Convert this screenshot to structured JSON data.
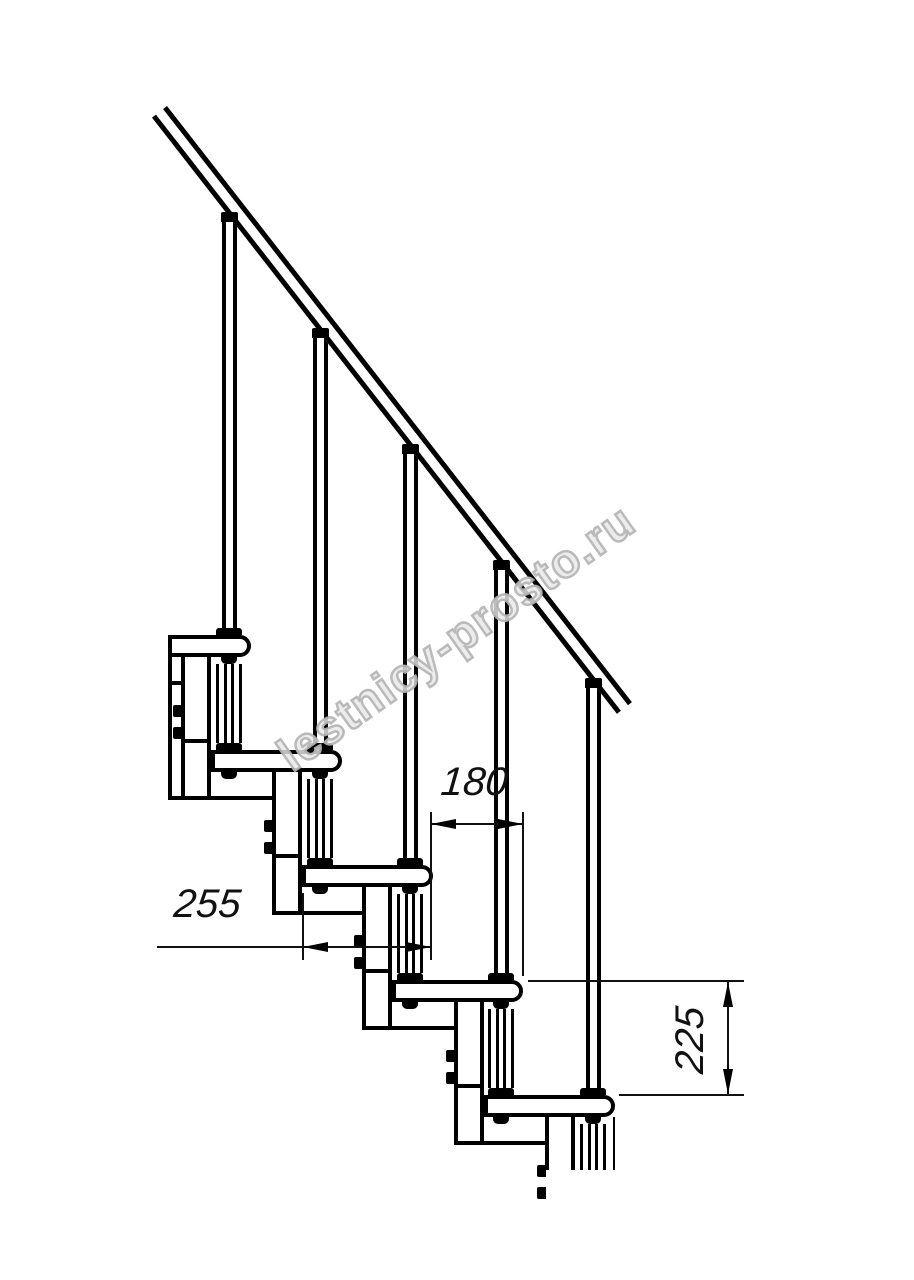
{
  "watermark": {
    "text": "lestnicy-prosto.ru",
    "color": "#bdbdbd"
  },
  "dimensions": {
    "run": {
      "value": "180"
    },
    "depth": {
      "value": "255"
    },
    "rise": {
      "value": "225"
    }
  },
  "colors": {
    "line": "#000000",
    "background": "#ffffff"
  }
}
